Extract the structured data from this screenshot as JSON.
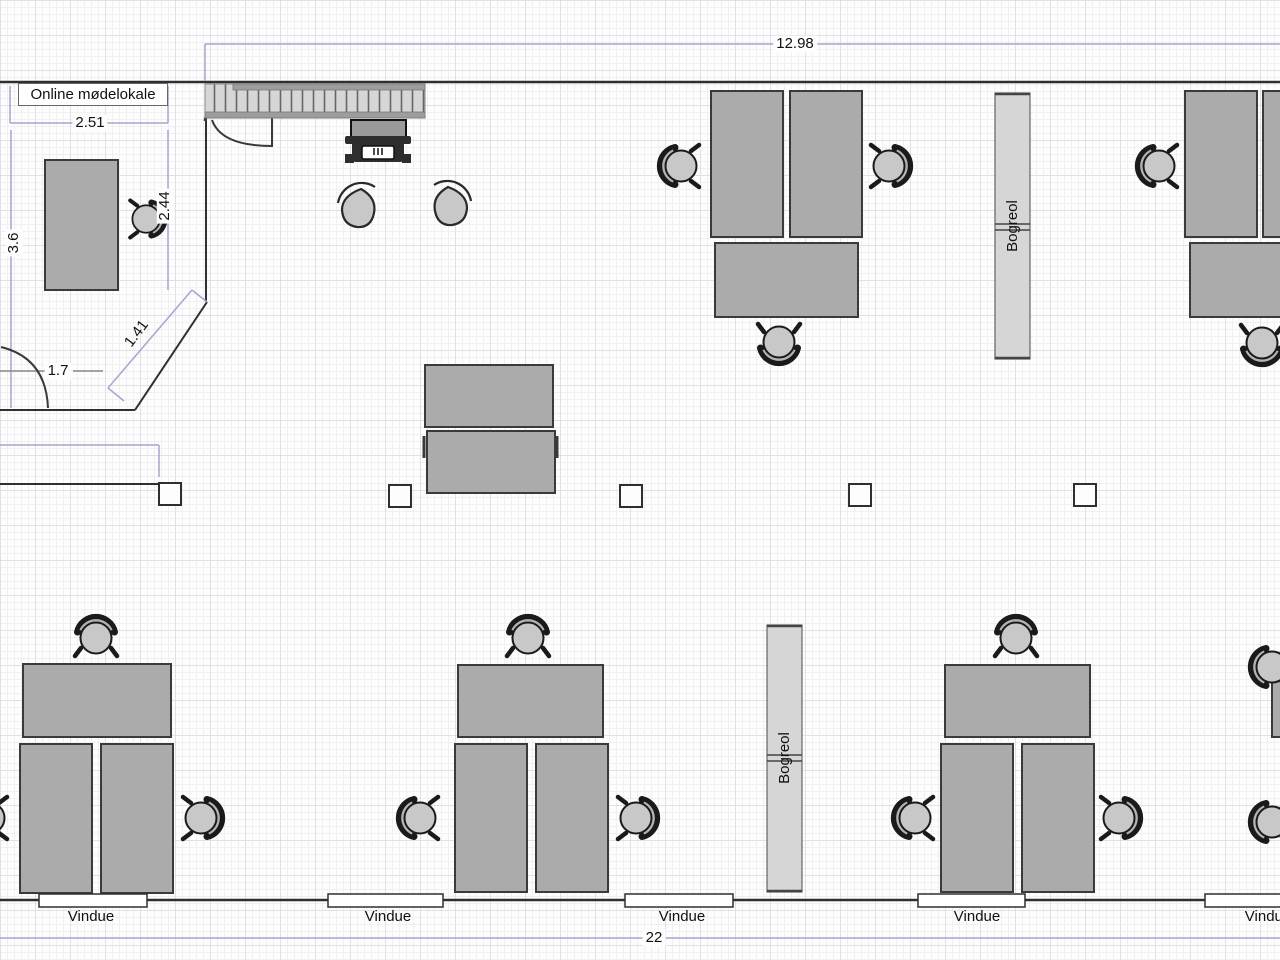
{
  "plan": {
    "room_label": "Online mødelokale",
    "dims": {
      "top_width": "12.98",
      "bottom_width": "22",
      "room_width": "2.51",
      "room_height_left": "3.6",
      "room_height_right": "2.44",
      "diagonal_wall": "1.41",
      "door_clearance": "1.7"
    },
    "bookshelf_top": {
      "label": "Bogreol"
    },
    "bookshelf_bottom": {
      "label": "Bogreol"
    },
    "windows": [
      {
        "label": "Vindue"
      },
      {
        "label": "Vindue"
      },
      {
        "label": "Vindue"
      },
      {
        "label": "Vindue"
      },
      {
        "label": "Vindue"
      }
    ],
    "colors": {
      "desk_fill": "#ababab",
      "chair_fill": "#c8c8c8",
      "shelf_fill": "#d6d6d6",
      "wall": "#2f2f2f",
      "dimension_line": "#a6a6cf"
    }
  }
}
